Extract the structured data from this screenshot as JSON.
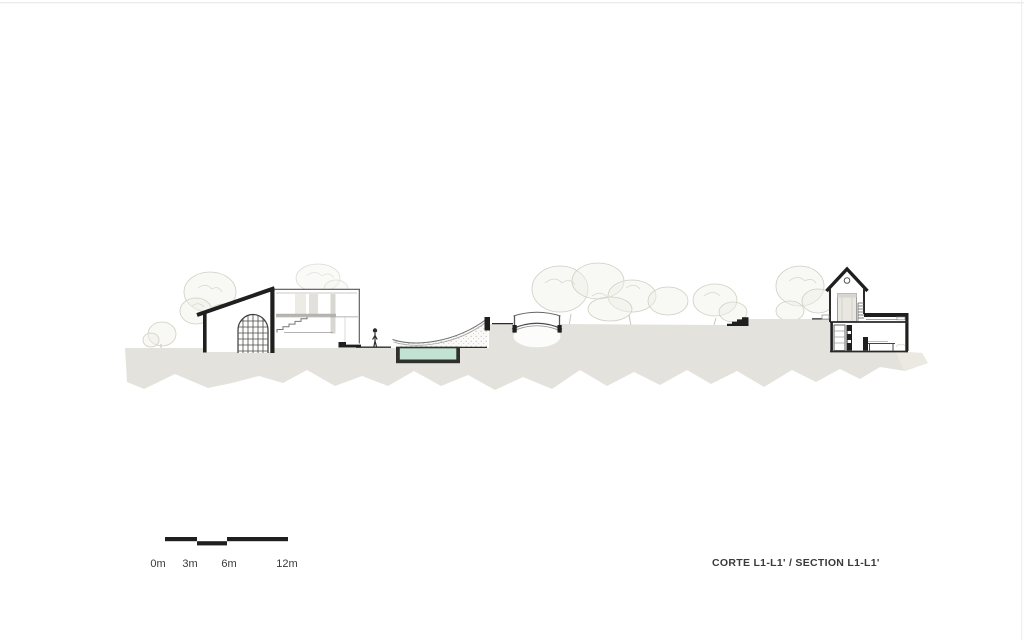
{
  "title_block": {
    "label": "CORTE L1-L1' / SECTION L1-L1'"
  },
  "scale_bar": {
    "labels": [
      "0m",
      "3m",
      "6m",
      "12m"
    ]
  },
  "colors": {
    "terrain": "#e4e2dc",
    "terrain_light": "#edebe5",
    "water": "#c2e3d3",
    "ink": "#1f1f1f",
    "text": "#3a3a3a",
    "tree": "#cfcfc1"
  }
}
